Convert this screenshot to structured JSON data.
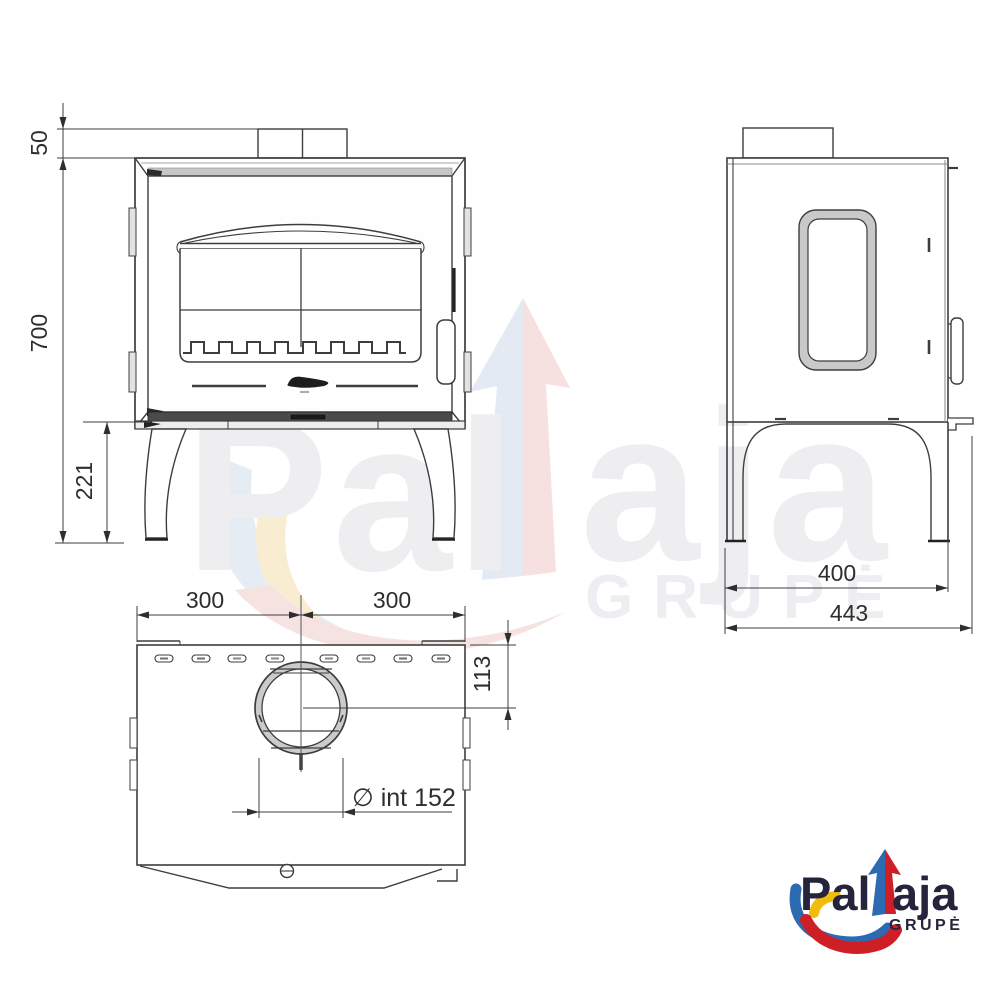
{
  "drawing": {
    "type": "stove technical drawing, three orthographic views",
    "line_color": "#3d3d3d",
    "background": "#ffffff"
  },
  "dimensions": {
    "front_view": {
      "collar_height_mm": "50",
      "body_height_mm": "700",
      "leg_clearance_mm": "221"
    },
    "top_view": {
      "half_width_left_mm": "300",
      "half_width_right_mm": "300",
      "flue_center_offset_mm": "113",
      "flue_inner_diameter": "∅ int 152"
    },
    "side_view": {
      "leg_span_mm": "400",
      "total_depth_mm": "443"
    }
  },
  "watermark": {
    "brand_left": "Pal",
    "brand_right": "aja",
    "subtitle": "GRUPĖ"
  },
  "logo": {
    "brand_left": "Pal",
    "brand_right": "aja",
    "subtitle": "GRUPĖ",
    "colors": {
      "blue": "#2c6ab2",
      "red": "#ce1f26",
      "yellow": "#f0bd0b",
      "text": "#26233c"
    }
  }
}
